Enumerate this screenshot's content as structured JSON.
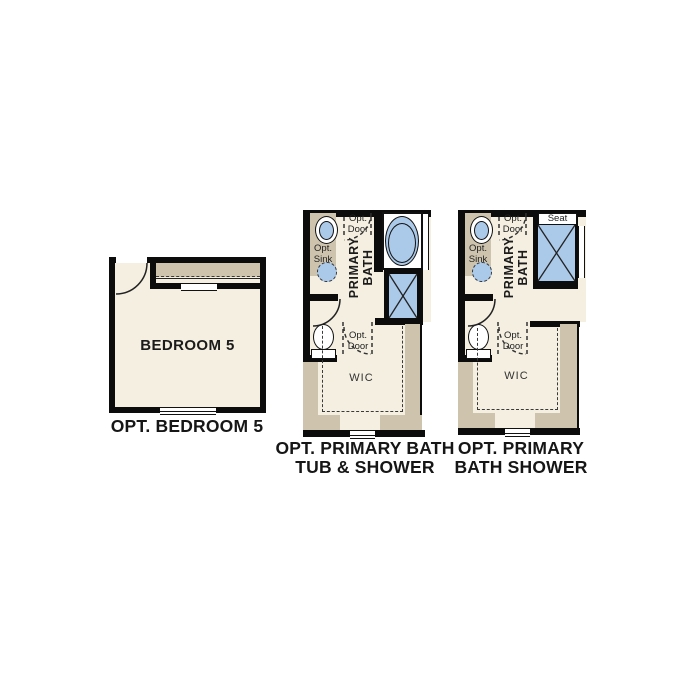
{
  "title": "Floor plan options",
  "colors": {
    "wall": "#0c0c0c",
    "floor": "#f4efe1",
    "cabinet_tan": "#cec4ae",
    "fixture_blue": "#abc9e8",
    "background": "#ffffff"
  },
  "plans": [
    {
      "id": "opt-bedroom-5",
      "room_label": "BEDROOM 5",
      "caption": "OPT. BEDROOM 5"
    },
    {
      "id": "opt-primary-bath-tub-shower",
      "room_label": "PRIMARY\nBATH",
      "caption": "OPT. PRIMARY BATH\nTUB & SHOWER",
      "labels": {
        "opt_sink": "Opt.\nSink",
        "opt_door_top": "Opt.\nDoor",
        "opt_door_wic": "Opt.\nDoor",
        "wic": "WIC"
      }
    },
    {
      "id": "opt-primary-bath-shower",
      "room_label": "PRIMARY\nBATH",
      "caption": "OPT. PRIMARY\nBATH SHOWER",
      "labels": {
        "opt_sink": "Opt.\nSink",
        "opt_door_top": "Opt.\nDoor",
        "opt_door_wic": "Opt.\nDoor",
        "wic": "WIC",
        "seat": "Seat"
      }
    }
  ]
}
